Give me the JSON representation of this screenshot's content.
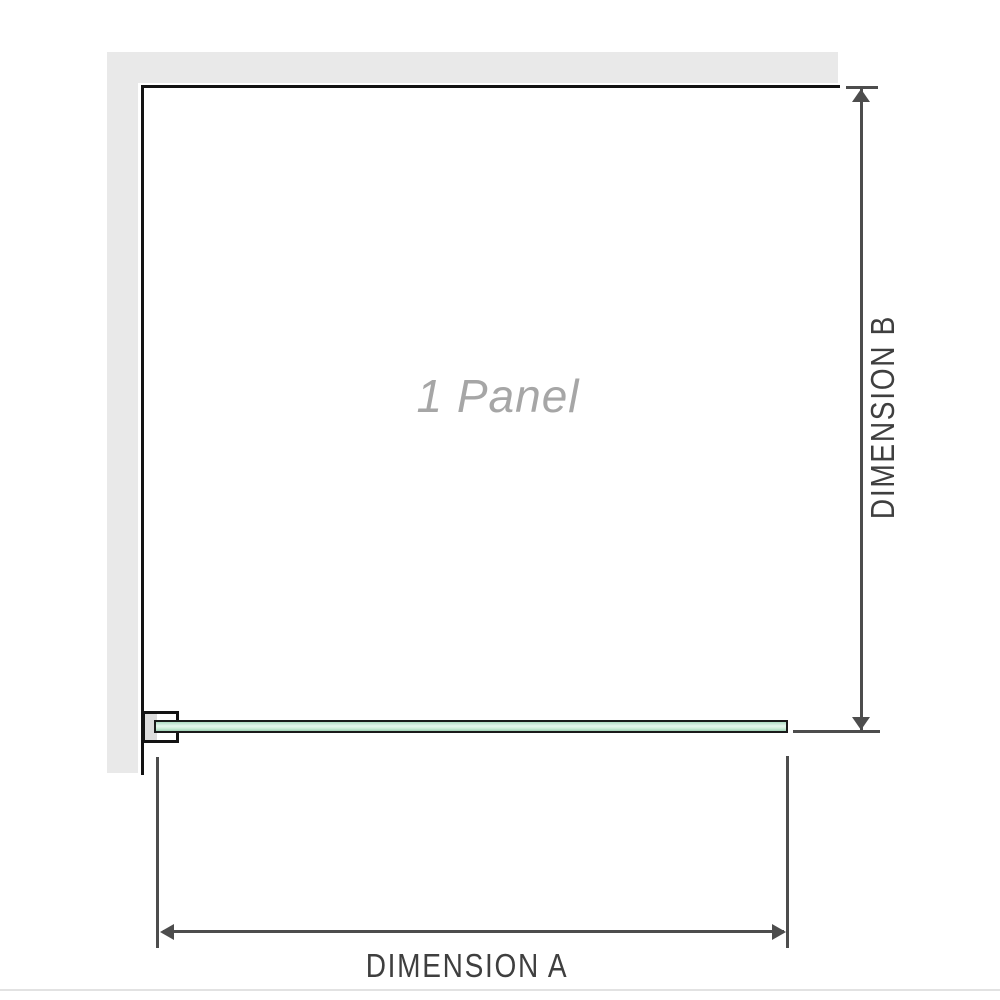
{
  "diagram": {
    "panel_label": "1 Panel",
    "dimensions": {
      "a_label": "DIMENSION A",
      "b_label": "DIMENSION B"
    },
    "icons": {
      "arrow_up": "triangle-up",
      "arrow_down": "triangle-down",
      "arrow_left": "triangle-left",
      "arrow_right": "triangle-right"
    },
    "colors": {
      "background": "#ffffff",
      "wall_fill": "#e9e9e9",
      "frame_line": "#131313",
      "glass_light": "#e7f7ee",
      "glass_dark": "#9fd2b5",
      "glass_border": "#1a1a1a",
      "bracket_pad": "#dcdcdc",
      "dimension_line": "#4d4d4d",
      "dimension_text": "#3f3f3f",
      "panel_label_text": "#a6a6a6",
      "baseline": "#e2e2e2"
    }
  }
}
